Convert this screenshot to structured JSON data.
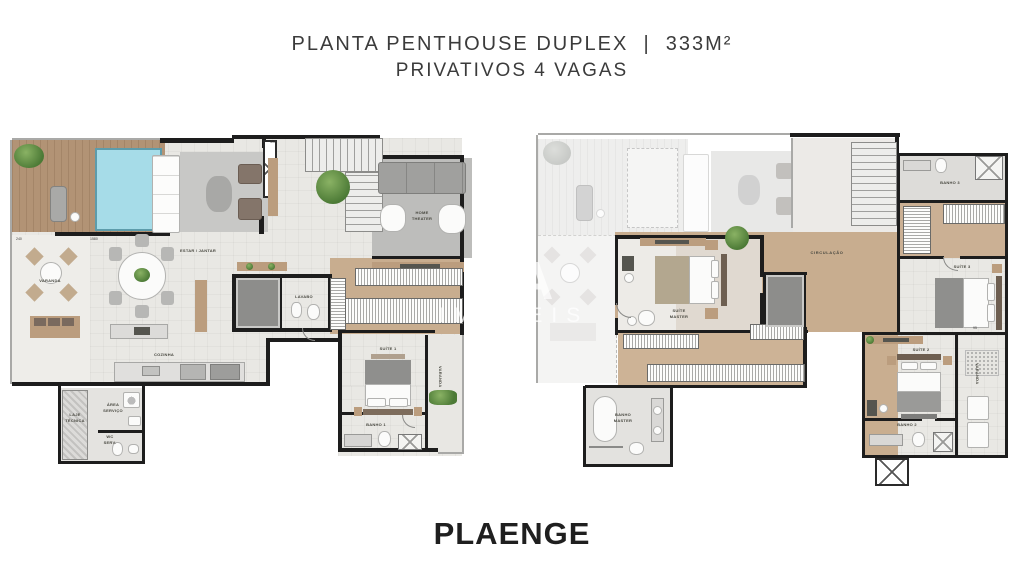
{
  "header": {
    "title_line1": "PLANTA PENTHOUSE DUPLEX  |  333M²",
    "title_line2": "PRIVATIVOS 4 VAGAS"
  },
  "watermark": {
    "line1": "ITA",
    "line2": "IMÓVEIS"
  },
  "brand": {
    "logo": "PLAENGE"
  },
  "lower": {
    "labels": {
      "varanda": "VARANDA",
      "estar_jantar": "ESTAR / JANTAR",
      "cozinha": "COZINHA",
      "home_theater": "HOME\nTHEATER",
      "lavabo": "LAVABO",
      "suite_1": "SUÍTE 1",
      "banho_1": "BANHO 1",
      "varanda_suite": "VARANDA",
      "area_servico": "ÁREA\nSERVIÇO",
      "wc_serv": "WC\nSERV.",
      "laje_tecnica": "LAJE\nTÉCNICA"
    },
    "dims": {
      "d240": "240",
      "d1580": "1580",
      "d410": "410"
    }
  },
  "upper": {
    "labels": {
      "circulacao": "CIRCULAÇÃO",
      "suite_master": "SUÍTE\nMASTER",
      "banho_master": "BANHO\nMASTER",
      "suite_2": "SUÍTE 2",
      "banho_2": "BANHO 2",
      "suite_3": "SUÍTE 3",
      "banho_3": "BANHO 3",
      "varanda": "VARANDA"
    },
    "dims": {
      "d95": "95"
    }
  },
  "colors": {
    "wall": "#1d1d1d",
    "deck_wood": "#b29375",
    "pool": "#a6dce8",
    "floor": "#e9e8e4",
    "corridor_wood": "#c8ad8f",
    "carpet": "#bcbcba",
    "plant_green": "#5d8f43",
    "title_text": "#3b3b3b"
  }
}
